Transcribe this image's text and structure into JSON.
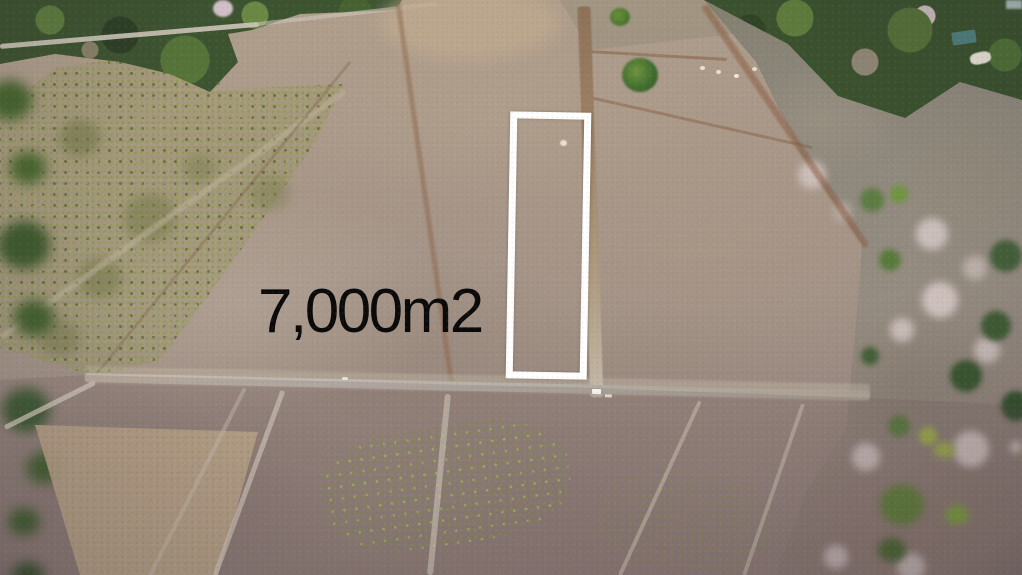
{
  "overlay": {
    "area_label": "7,000m2",
    "label_color": "#0a0a0a",
    "outline_color": "#ffffff"
  },
  "scene": {
    "type": "aerial-drone-photo-of-land-plots",
    "marked_plot": "tall narrow parcel outlined in white right of the center dirt road",
    "features": [
      "forest strip top-left with gravel road",
      "forest and flowering trees along right side",
      "cleared dirt fields divided into plots",
      "vertical dirt road in center",
      "horizontal gravel road across lower third",
      "mottled scrub field on left",
      "small white vehicles on road",
      "house with teal roof in top-right trees"
    ],
    "palette": {
      "field_tan": "#a89787",
      "field_dark": "#8d7c76",
      "scrub_olive": "#8f9a52",
      "forest_green": "#3d5430",
      "boundary_brown": "#8a5f43",
      "road_gray": "#bfb8ae",
      "blossom_pink": "#d0c3c0"
    }
  }
}
